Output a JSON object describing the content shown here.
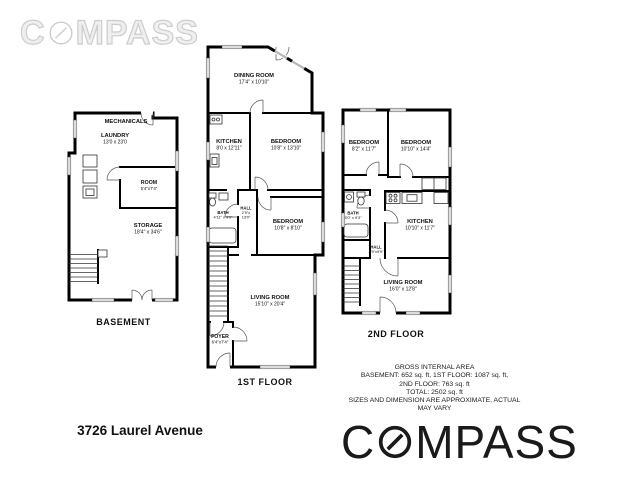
{
  "brand": {
    "name": "COMPASS",
    "logo_prefix": "C",
    "logo_suffix": "MPASS"
  },
  "colors": {
    "wall": "#000000",
    "window_fill": "#dcdcdc",
    "logo": "#1a1a1a",
    "watermark": "#cdcdcd"
  },
  "plans": {
    "basement": {
      "label": "BASEMENT",
      "rooms": {
        "mechanicals": {
          "name": "MECHANICALS"
        },
        "laundry": {
          "name": "LAUNDRY",
          "dims": "13'0 x 23'0"
        },
        "room": {
          "name": "ROOM",
          "dims": "5'4\"x7'4\""
        },
        "storage": {
          "name": "STORAGE",
          "dims": "18'4\" x 34'6\""
        }
      }
    },
    "first_floor": {
      "label": "1ST FLOOR",
      "rooms": {
        "dining_room": {
          "name": "DINING ROOM",
          "dims": "17'4\" x 10'10\""
        },
        "kitchen": {
          "name": "KITCHEN",
          "dims": "8'0 x 12'11\""
        },
        "bedroom_rear": {
          "name": "BEDROOM",
          "dims": "10'8\" x 13'10\""
        },
        "bath": {
          "name": "BATH",
          "dims": "4'11\" x 9'9\""
        },
        "hall": {
          "name": "HALL",
          "dims_line1": "2'9\"x",
          "dims_line2": "13'0\""
        },
        "bedroom_middle": {
          "name": "BEDROOM",
          "dims": "10'8\" x 8'10\""
        },
        "living_room": {
          "name": "LIVING ROOM",
          "dims": "15'10\" x 20'4\""
        },
        "foyer": {
          "name": "FOYER",
          "dims": "6'4\"x7'4\""
        }
      }
    },
    "second_floor": {
      "label": "2ND FLOOR",
      "rooms": {
        "bedroom_left": {
          "name": "BEDROOM",
          "dims": "8'2\" x 11'7\""
        },
        "bedroom_right": {
          "name": "BEDROOM",
          "dims": "10'10\" x 14'4\""
        },
        "bath": {
          "name": "BATH",
          "dims": "5'0\" x 9'3\""
        },
        "kitchen": {
          "name": "KITCHEN",
          "dims": "10'10\" x 11'7\""
        },
        "hall": {
          "name": "HALL",
          "dims": "4'9\"x9'9\""
        },
        "living_room": {
          "name": "LIVING ROOM",
          "dims": "16'0\" x 12'8\""
        }
      }
    }
  },
  "footer": {
    "address": "3726 Laurel Avenue",
    "area_summary": {
      "title": "GROSS INTERNAL AREA",
      "line1": "BASEMENT: 652 sq. ft, 1ST FLOOR: 1087 sq. ft,",
      "line2": "2ND FLOOR: 763 sq. ft",
      "line3": "TOTAL: 2502 sq. ft",
      "disclaimer": "SIZES AND DIMENSION ARE APPROXIMATE, ACTUAL MAY  VARY"
    }
  }
}
